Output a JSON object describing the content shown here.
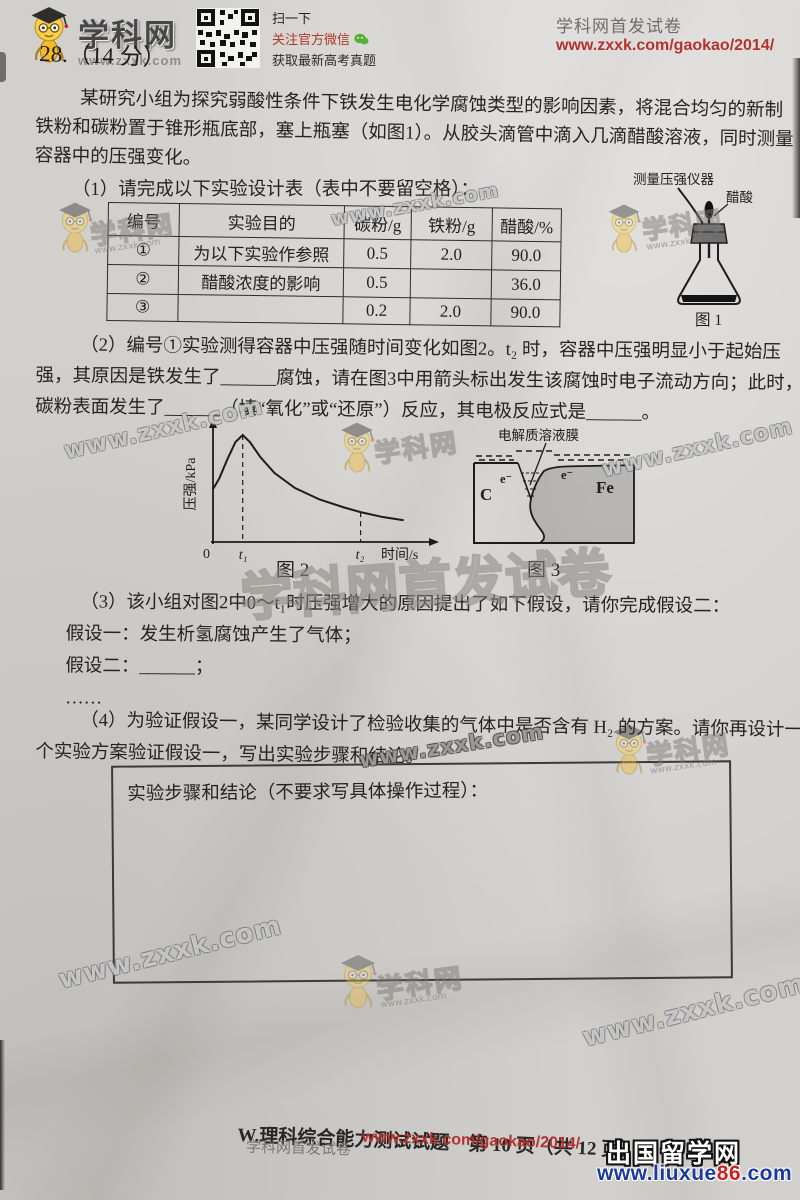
{
  "header": {
    "logo_text": "学科网",
    "logo_url": "www.zxxk.com",
    "qr_caption_1": "扫一下",
    "qr_caption_2": "关注官方微信",
    "qr_caption_3": "获取最新高考真题",
    "right_title": "学科网首发试卷",
    "right_url": "www.zxxk.com/gaokao/2014/"
  },
  "question": {
    "number_line": "28.（14 分）",
    "intro_lines": [
      "某研究小组为探究弱酸性条件下铁发生电化学腐蚀类型的影响因素，将混合均匀的新制",
      "铁粉和碳粉置于锥形瓶底部，塞上瓶塞（如图1）。从胶头滴管中滴入几滴醋酸溶液，同时测量",
      "容器中的压强变化。"
    ],
    "part1_label": "（1）请完成以下实验设计表（表中不要留空格）：",
    "table": {
      "headers": [
        "编号",
        "实验目的",
        "碳粉/g",
        "铁粉/g",
        "醋酸/%"
      ],
      "rows": [
        [
          "①",
          "为以下实验作参照",
          "0.5",
          "2.0",
          "90.0"
        ],
        [
          "②",
          "醋酸浓度的影响",
          "0.5",
          "",
          "36.0"
        ],
        [
          "③",
          "",
          "0.2",
          "2.0",
          "90.0"
        ]
      ]
    },
    "part2_lines": [
      "（2）编号①实验测得容器中压强随时间变化如图2。t₂ 时，容器中压强明显小于起始压",
      "强，其原因是铁发生了______腐蚀，请在图3中用箭头标出发生该腐蚀时电子流动方向；此时，",
      "碳粉表面发生了______（填“氧化”或“还原”）反应，其电极反应式是______。"
    ],
    "part3_lines": [
      "（3）该小组对图2中0～t₁时压强增大的原因提出了如下假设，请你完成假设二：",
      "假设一：发生析氢腐蚀产生了气体；",
      "假设二：______；",
      "……"
    ],
    "part4_lines": [
      "（4）为验证假设一，某同学设计了检验收集的气体中是否含有 H₂ 的方案。请你再设计一",
      "个实验方案验证假设一，写出实验步骤和结论。"
    ],
    "answer_box_label": "实验步骤和结论（不要求写具体操作过程）："
  },
  "figure1": {
    "caption": "图 1",
    "label_instrument": "测量压强仪器",
    "label_acid": "醋酸"
  },
  "figure2": {
    "caption": "图 2",
    "ylabel": "压强/kPa",
    "xlabel": "时间/s",
    "origin": "0",
    "t1_label": "t₁",
    "t2_label": "t₂"
  },
  "figure3": {
    "caption": "图 3",
    "label_film": "电解质溶液膜",
    "label_carbon": "C",
    "label_iron": "Fe",
    "label_e_left": "e⁻",
    "label_e_right": "e⁻"
  },
  "chart_data": {
    "type": "line",
    "title": "图2 容器中压强随时间的变化",
    "xlabel": "时间/s",
    "ylabel": "压强/kPa",
    "x_ticks": [
      "0",
      "t₁",
      "t₂"
    ],
    "axis_note": "坐标轴无数值刻度，数据为归一化估读值(0–1)",
    "series": [
      {
        "name": "压强",
        "x": [
          0,
          0.03,
          0.07,
          0.11,
          0.145,
          0.18,
          0.23,
          0.3,
          0.4,
          0.52,
          0.64,
          0.72,
          0.82,
          0.93
        ],
        "y": [
          0.46,
          0.55,
          0.72,
          0.87,
          0.93,
          0.87,
          0.74,
          0.6,
          0.47,
          0.37,
          0.3,
          0.26,
          0.22,
          0.19
        ]
      }
    ],
    "t1": {
      "x": 0.145,
      "y": 0.93
    },
    "t2": {
      "x": 0.72,
      "y": 0.26
    },
    "annotations": [
      "0～t₁压强增大，t₁处达最大值",
      "t₂时压强明显小于起始压强"
    ],
    "legend": false,
    "grid": false
  },
  "watermarks": {
    "url": "www.zxxk.com",
    "brand": "学科网",
    "big": "学科网首发试卷"
  },
  "footer": {
    "page_line": "W.理科综合能力测试试题　第 10 页（共 12 页）",
    "left_gray": "学科网首发试卷",
    "left_red": "www.zxxk.com/gaokao/2014/",
    "site_name": "出国留学网",
    "site_url_prefix": "www.liuxue",
    "site_url_num": "86",
    "site_url_suffix": ".com"
  },
  "colors": {
    "paper": "#d2d0cc",
    "ink": "#242424",
    "accent_red": "#b23430",
    "wechat_green": "#55b135",
    "iron_gray": "#bdbdbd"
  }
}
